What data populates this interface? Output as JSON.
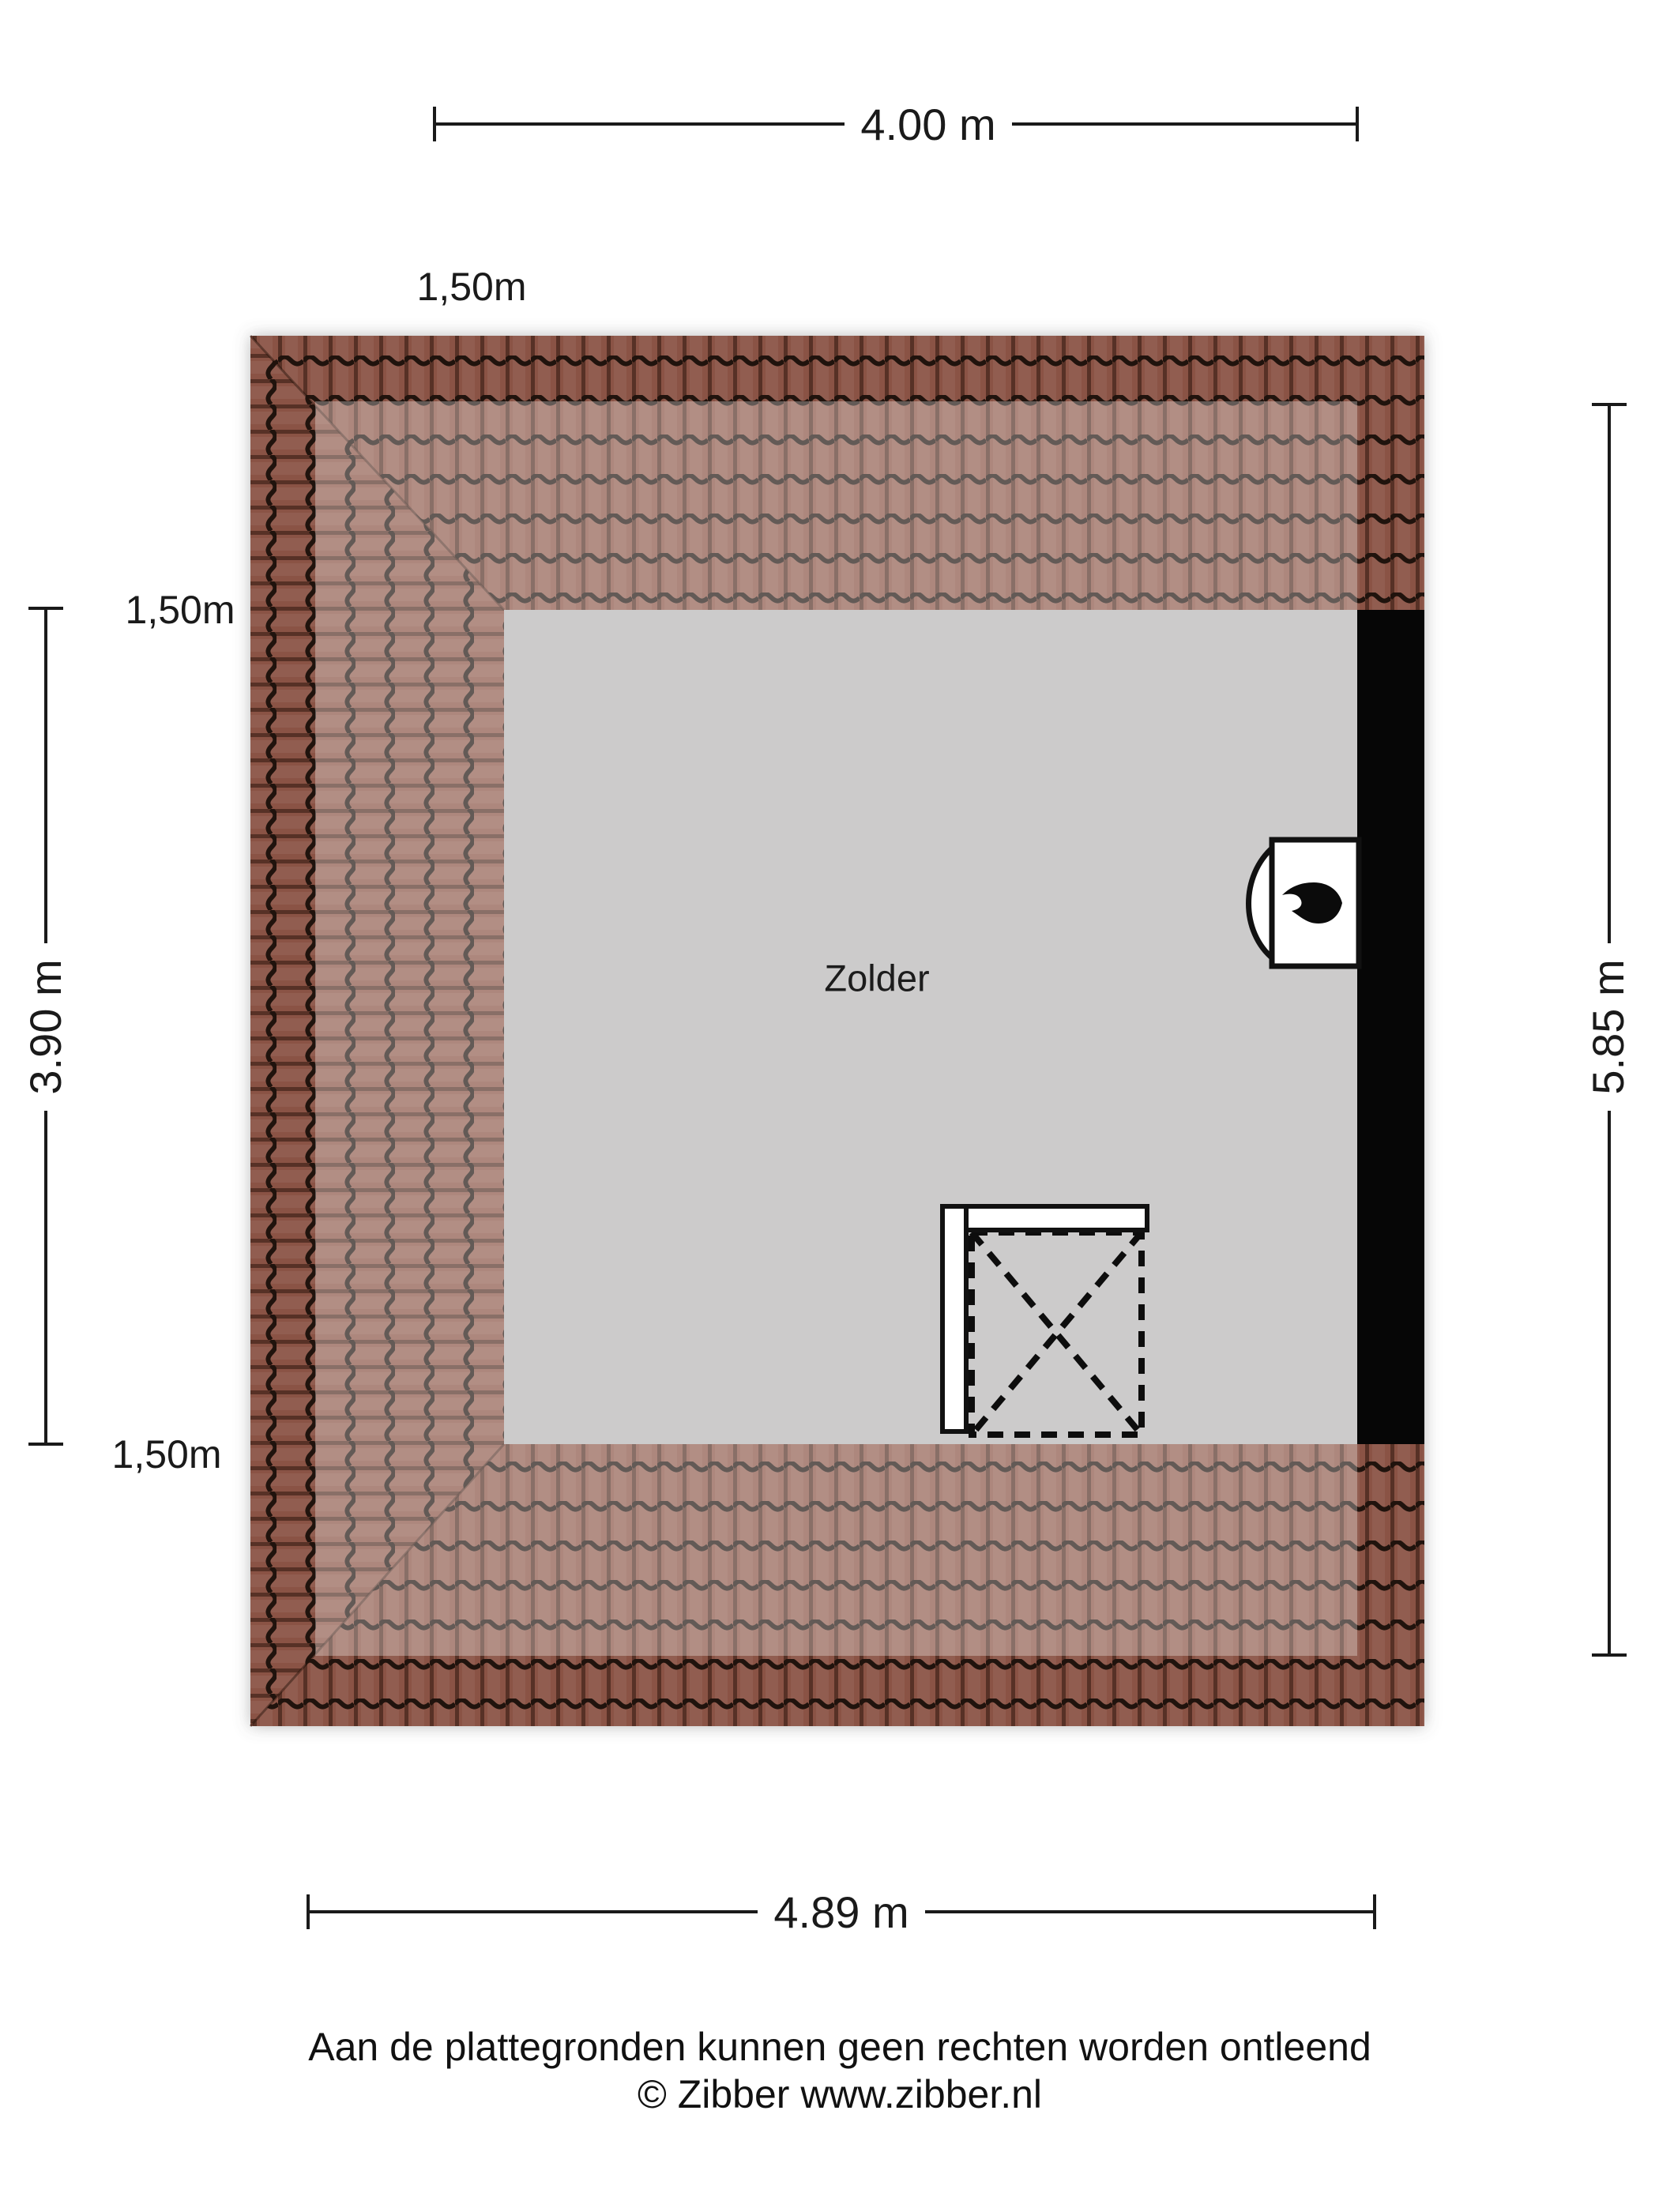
{
  "plan": {
    "room": {
      "label": "Zolder"
    },
    "dimensions": {
      "top": "4.00 m",
      "bottom": "4.89 m",
      "left": "3.90 m",
      "right": "5.85 m"
    },
    "height_contours": {
      "top": "1,50m",
      "left": "1,50m",
      "bottom": "1,50m"
    },
    "icons": {
      "boiler": "flame-icon"
    }
  },
  "footer": {
    "disclaimer": "Aan de plattegronden kunnen geen rechten worden ontleend",
    "copyright": "© Zibber www.zibber.nl"
  },
  "colors": {
    "floor": "#cccbcb",
    "wall": "#060606",
    "tile": "#8a5345",
    "tile_line": "#20130d",
    "dim_line": "#1a1a1a"
  }
}
